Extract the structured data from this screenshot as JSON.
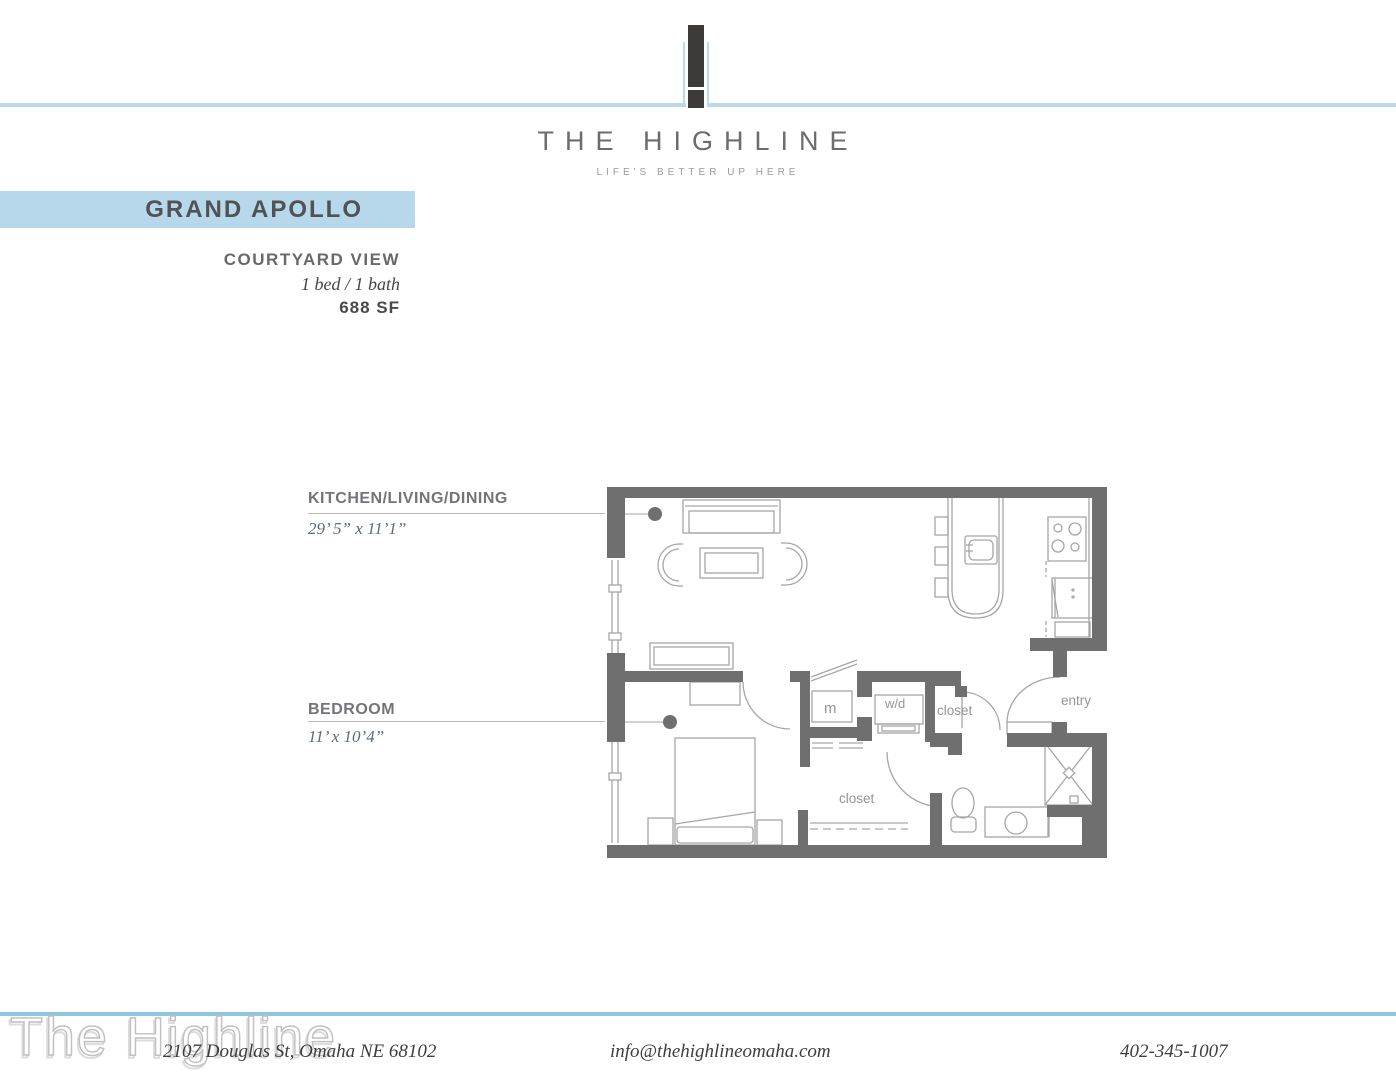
{
  "brand": {
    "wordmark": "THE HIGHLINE",
    "tagline": "LIFE'S BETTER UP HERE"
  },
  "unit": {
    "name": "GRAND APOLLO",
    "view": "COURTYARD VIEW",
    "beds_baths": "1 bed / 1 bath",
    "area": "688 SF"
  },
  "rooms": {
    "kitchen_living_dining": {
      "label": "KITCHEN/LIVING/DINING",
      "dimensions": "29’ 5” x 11’1”"
    },
    "bedroom": {
      "label": "BEDROOM",
      "dimensions": "11’ x 10’4”"
    }
  },
  "plan": {
    "labels": {
      "mechanical": "m",
      "washer_dryer": "w/d",
      "coat_closet": "closet",
      "entry": "entry",
      "walk_in_closet": "closet"
    }
  },
  "footer": {
    "watermark": "The Highline",
    "address": "2107 Douglas St, Omaha NE 68102",
    "email": "info@thehighlineomaha.com",
    "phone": "402-345-1007"
  },
  "colors": {
    "accent_light_blue": "#b9d9ec",
    "banner_blue": "#b7d8ea",
    "footer_blue": "#8cc8e2",
    "wall_gray": "#6f6f6f",
    "plan_line_gray": "#a6a6a6",
    "logo_dark": "#3e3a39"
  }
}
